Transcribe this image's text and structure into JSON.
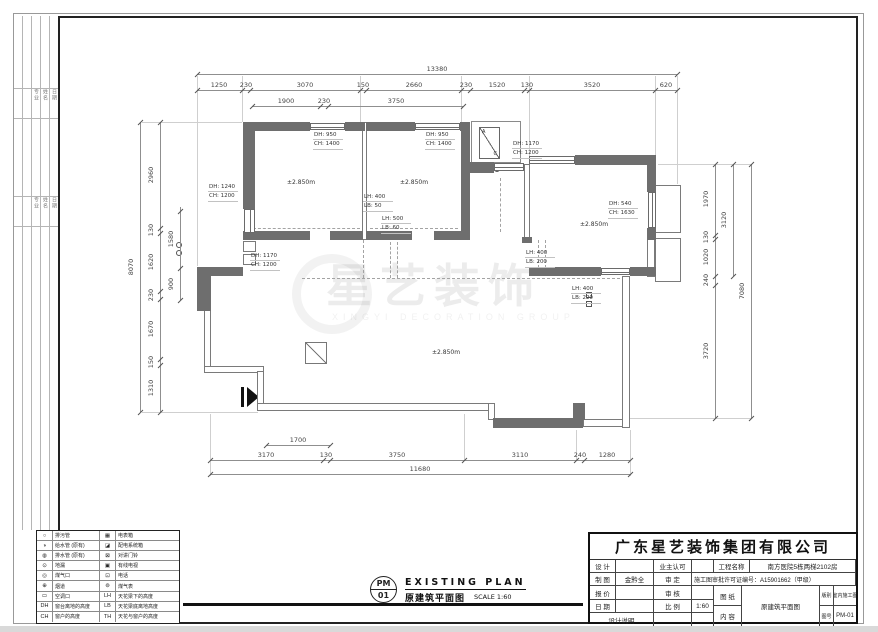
{
  "watermark": {
    "text": "星艺装饰",
    "sub": "XINGYI DECORATION GROUP"
  },
  "strip": {
    "labels": [
      "专业",
      "姓名",
      "日期"
    ]
  },
  "drawing_title": {
    "pm_top": "PM",
    "pm_bottom": "01",
    "en": "EXISTING PLAN",
    "cn": "原建筑平面图",
    "scale": "SCALE 1:60"
  },
  "title_block": {
    "company": "广东星艺装饰集团有限公司",
    "design_label": "设 计",
    "owner_label": "业主认可",
    "draft_label": "制 图",
    "draft_value": "金黔全",
    "approve_label": "审 定",
    "quote_label": "报 价",
    "audit_label": "审 核",
    "date_label": "日 期",
    "scale_label": "比 例",
    "scale_value": "1:60",
    "notes_label": "设计说明",
    "project_label": "工程名称",
    "project_value": "南方医院5栋两梯2102房",
    "permit": "施工图审批许可证编号：A15901662（甲级）",
    "sheet_label_1": "图 纸",
    "sheet_label_2": "内 容",
    "sheet_value": "原建筑平面图",
    "type_label": "版别",
    "type_value": "室内施工图",
    "no_label": "图号",
    "no_value": "PM-01"
  },
  "legend": {
    "rows": [
      {
        "s1": "○",
        "t1": "排污管",
        "s2": "▦",
        "t2": "电表箱"
      },
      {
        "s1": "◑",
        "t1": "给水管 (原有)",
        "s2": "◪",
        "t2": "配电系统箱"
      },
      {
        "s1": "◍",
        "t1": "排水管 (原有)",
        "s2": "⊠",
        "t2": "对讲门铃"
      },
      {
        "s1": "⊙",
        "t1": "地漏",
        "s2": "▣",
        "t2": "有线电视"
      },
      {
        "s1": "◎",
        "t1": "煤气口",
        "s2": "⊡",
        "t2": "电话"
      },
      {
        "s1": "⊕",
        "t1": "烟道",
        "s2": "⊚",
        "t2": "煤气表"
      },
      {
        "s1": "▭",
        "t1": "空调口",
        "s2": "LH",
        "t2": "天花梁下的高度"
      },
      {
        "s1": "DH",
        "t1": "窗台离地的高度",
        "s2": "LB",
        "t2": "天花梁底离地高度"
      },
      {
        "s1": "CH",
        "t1": "窗户的高度",
        "s2": "TH",
        "t2": "天花与窗户的高度"
      }
    ]
  },
  "plan": {
    "level_label": "±2.850m",
    "level_positions": [
      [
        287,
        179
      ],
      [
        400,
        179
      ],
      [
        580,
        221
      ],
      [
        432,
        349
      ]
    ],
    "ac_letters": [
      "A",
      "C"
    ],
    "walls": [
      [
        243,
        122,
        67,
        9
      ],
      [
        345,
        122,
        20,
        9
      ],
      [
        366,
        122,
        49,
        9
      ],
      [
        460,
        122,
        10,
        9
      ],
      [
        243,
        131,
        12,
        78
      ],
      [
        243,
        231,
        12,
        9
      ],
      [
        243,
        231,
        67,
        9
      ],
      [
        330,
        231,
        33,
        9
      ],
      [
        366,
        231,
        46,
        9
      ],
      [
        434,
        231,
        36,
        9
      ],
      [
        461,
        131,
        9,
        100
      ],
      [
        470,
        162,
        24,
        11
      ],
      [
        575,
        155,
        80,
        10
      ],
      [
        647,
        155,
        9,
        37
      ],
      [
        647,
        228,
        9,
        12
      ],
      [
        529,
        267,
        72,
        9
      ],
      [
        630,
        267,
        26,
        9
      ],
      [
        647,
        267,
        9,
        9
      ],
      [
        197,
        267,
        14,
        44
      ],
      [
        197,
        267,
        46,
        9
      ],
      [
        493,
        418,
        90,
        10
      ],
      [
        573,
        403,
        12,
        17
      ],
      [
        522,
        237,
        10,
        6
      ]
    ],
    "thin": [
      [
        362,
        122,
        5,
        118
      ],
      [
        524,
        164,
        6,
        74
      ],
      [
        204,
        309,
        7,
        61
      ],
      [
        204,
        366,
        60,
        7
      ],
      [
        257,
        371,
        7,
        34
      ],
      [
        257,
        403,
        238,
        8
      ],
      [
        488,
        403,
        7,
        17
      ],
      [
        583,
        419,
        47,
        8
      ],
      [
        622,
        276,
        8,
        152
      ],
      [
        647,
        237,
        8,
        40
      ],
      [
        655,
        185,
        26,
        48
      ],
      [
        655,
        238,
        26,
        44
      ],
      [
        243,
        241,
        13,
        11
      ],
      [
        243,
        254,
        13,
        11
      ]
    ],
    "windows": [
      [
        310,
        123,
        35,
        7,
        "h"
      ],
      [
        415,
        123,
        45,
        7,
        "h"
      ],
      [
        494,
        163,
        30,
        8,
        "h"
      ],
      [
        529,
        156,
        46,
        8,
        "h"
      ],
      [
        601,
        268,
        29,
        7,
        "h"
      ],
      [
        244,
        209,
        11,
        24,
        "v"
      ],
      [
        648,
        192,
        8,
        36,
        "v"
      ]
    ],
    "dashes": [
      [
        302,
        278,
        318,
        "h"
      ],
      [
        248,
        228,
        112,
        "h"
      ],
      [
        370,
        228,
        88,
        "h"
      ],
      [
        390,
        242,
        36,
        "v"
      ],
      [
        397,
        242,
        36,
        "v"
      ],
      [
        500,
        178,
        54,
        "v"
      ],
      [
        538,
        240,
        28,
        "v"
      ],
      [
        545,
        240,
        28,
        "v"
      ],
      [
        363,
        240,
        38,
        "v"
      ]
    ],
    "ext": [
      [
        197,
        76,
        1,
        190
      ],
      [
        677,
        76,
        1,
        108
      ],
      [
        242,
        76,
        1,
        46
      ],
      [
        360,
        76,
        1,
        46
      ],
      [
        461,
        76,
        1,
        46
      ],
      [
        529,
        76,
        1,
        80
      ],
      [
        655,
        76,
        1,
        80
      ],
      [
        142,
        122,
        100,
        1
      ],
      [
        142,
        412,
        116,
        1
      ],
      [
        658,
        164,
        94,
        1
      ],
      [
        630,
        418,
        122,
        1
      ],
      [
        210,
        414,
        1,
        62
      ],
      [
        630,
        430,
        1,
        46
      ],
      [
        464,
        414,
        1,
        46
      ],
      [
        576,
        430,
        1,
        30
      ]
    ],
    "tags": [
      {
        "x": 313,
        "y": 131,
        "l1": "DH: 950",
        "l2": "CH: 1400"
      },
      {
        "x": 425,
        "y": 131,
        "l1": "DH: 950",
        "l2": "CH: 1400"
      },
      {
        "x": 512,
        "y": 140,
        "l1": "DH: 1170",
        "l2": "CH: 1200"
      },
      {
        "x": 208,
        "y": 183,
        "l1": "DH: 1240",
        "l2": "CH: 1200"
      },
      {
        "x": 250,
        "y": 252,
        "l1": "DH: 1170",
        "l2": "CH: 1200"
      },
      {
        "x": 608,
        "y": 200,
        "l1": "DH: 540",
        "l2": "CH: 1630"
      },
      {
        "x": 363,
        "y": 193,
        "l1": "LH: 400",
        "l2": "LB: 50"
      },
      {
        "x": 381,
        "y": 215,
        "l1": "LH: 500",
        "l2": "LB: 60"
      },
      {
        "x": 525,
        "y": 249,
        "l1": "LH: 400",
        "l2": "LB: 200"
      },
      {
        "x": 571,
        "y": 285,
        "l1": "LH: 400",
        "l2": "LB: 220"
      }
    ]
  },
  "dims": {
    "h": [
      {
        "y": 74,
        "x1": 197,
        "x2": 677,
        "pts": [
          197,
          677
        ],
        "labels": [
          [
            "13380",
            437
          ]
        ]
      },
      {
        "y": 90,
        "x1": 197,
        "x2": 677,
        "pts": [
          197,
          242,
          250,
          360,
          366,
          461,
          470,
          524,
          529,
          655,
          677
        ],
        "labels": [
          [
            "1250",
            219
          ],
          [
            "230",
            246
          ],
          [
            "3070",
            305
          ],
          [
            "150",
            363
          ],
          [
            "2660",
            414
          ],
          [
            "230",
            466
          ],
          [
            "1520",
            497
          ],
          [
            "130",
            527
          ],
          [
            "3520",
            592
          ],
          [
            "620",
            666
          ]
        ]
      },
      {
        "y": 106,
        "x1": 252,
        "x2": 463,
        "pts": [
          252,
          320,
          328,
          463
        ],
        "labels": [
          [
            "1900",
            286
          ],
          [
            "230",
            324
          ],
          [
            "3750",
            396
          ]
        ]
      },
      {
        "y": 445,
        "x1": 266,
        "x2": 330,
        "pts": [
          266,
          330
        ],
        "labels": [
          [
            "1700",
            298
          ]
        ]
      },
      {
        "y": 460,
        "x1": 210,
        "x2": 630,
        "pts": [
          210,
          323,
          330,
          464,
          576,
          584,
          630
        ],
        "labels": [
          [
            "3170",
            266
          ],
          [
            "130",
            326
          ],
          [
            "3750",
            397
          ],
          [
            "3110",
            520
          ],
          [
            "240",
            580
          ],
          [
            "1280",
            607
          ]
        ]
      },
      {
        "y": 474,
        "x1": 210,
        "x2": 630,
        "pts": [
          210,
          630
        ],
        "labels": [
          [
            "11680",
            420
          ]
        ]
      }
    ],
    "v": [
      {
        "x": 140,
        "y1": 122,
        "y2": 412,
        "pts": [
          122,
          412
        ],
        "labels": [
          [
            "8070",
            267
          ]
        ]
      },
      {
        "x": 160,
        "y1": 122,
        "y2": 412,
        "pts": [
          122,
          228,
          233,
          291,
          299,
          359,
          365,
          412
        ],
        "labels": [
          [
            "2960",
            175
          ],
          [
            "130",
            230
          ],
          [
            "1620",
            262
          ],
          [
            "230",
            295
          ],
          [
            "1670",
            329
          ],
          [
            "150",
            362
          ],
          [
            "1310",
            388
          ]
        ]
      },
      {
        "x": 180,
        "y1": 207,
        "y2": 300,
        "pts": [
          211,
          268,
          300
        ],
        "labels": [
          [
            "1580",
            239
          ],
          [
            "900",
            284
          ]
        ]
      },
      {
        "x": 715,
        "y1": 164,
        "y2": 418,
        "pts": [
          164,
          235,
          239,
          276,
          285,
          418
        ],
        "labels": [
          [
            "1970",
            199
          ],
          [
            "130",
            237
          ],
          [
            "1020",
            257
          ],
          [
            "240",
            280
          ],
          [
            "3720",
            351
          ]
        ]
      },
      {
        "x": 733,
        "y1": 164,
        "y2": 276,
        "pts": [
          164,
          276
        ],
        "labels": [
          [
            "3120",
            220
          ]
        ]
      },
      {
        "x": 751,
        "y1": 164,
        "y2": 418,
        "pts": [
          164,
          418
        ],
        "labels": [
          [
            "7080",
            291
          ]
        ]
      }
    ]
  }
}
